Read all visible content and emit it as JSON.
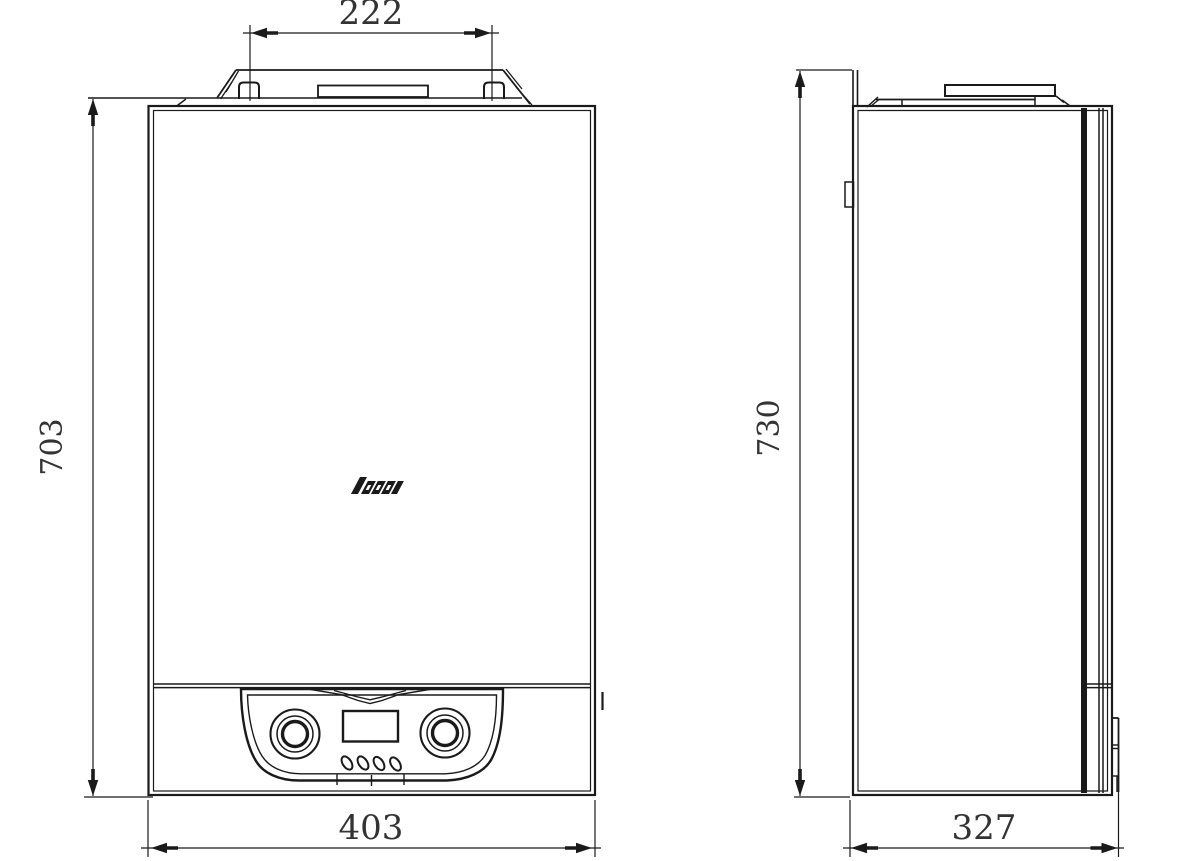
{
  "drawing": {
    "type": "technical-dimension-drawing",
    "views": {
      "front": {
        "dimensions": {
          "mount_width": "222",
          "height": "703",
          "width": "403"
        }
      },
      "side": {
        "dimensions": {
          "height": "730",
          "depth": "327"
        }
      }
    },
    "colors": {
      "line": "#1a1a1a",
      "dimension_text": "#333333",
      "background": "#ffffff"
    }
  }
}
